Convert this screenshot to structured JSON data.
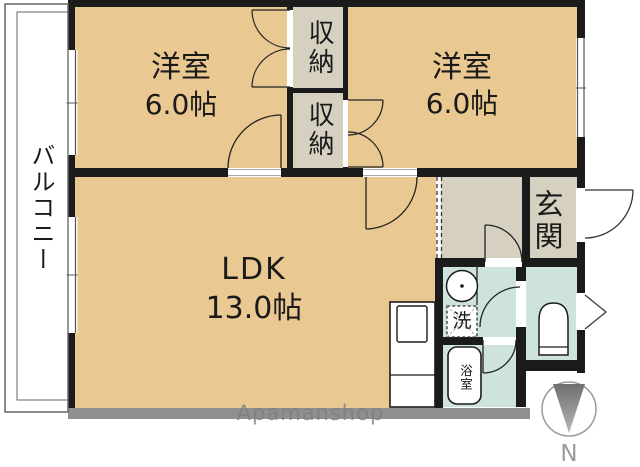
{
  "floorplan": {
    "balcony": {
      "label": "バルコニー"
    },
    "bedroom_left": {
      "name": "洋室",
      "size": "6.0帖"
    },
    "bedroom_right": {
      "name": "洋室",
      "size": "6.0帖"
    },
    "closet_upper": {
      "label": "収納"
    },
    "closet_lower": {
      "label": "収納"
    },
    "ldk": {
      "name": "LDK",
      "size": "13.0帖"
    },
    "entrance": {
      "label": "玄関"
    },
    "laundry": {
      "label": "洗"
    },
    "bathroom": {
      "label": "浴室"
    },
    "compass": {
      "label": "N"
    },
    "watermark": {
      "text": "Apamanshop"
    }
  },
  "colors": {
    "room_fill": "#e9c892",
    "storage_fill": "#d6d0c1",
    "wet_area_fill": "#cfe3de",
    "wall": "#1b1b1b",
    "bottom_wall": "#8f8f8f",
    "watermark_text": "#7e7e7e",
    "compass_gray": "#9b9b9b"
  }
}
